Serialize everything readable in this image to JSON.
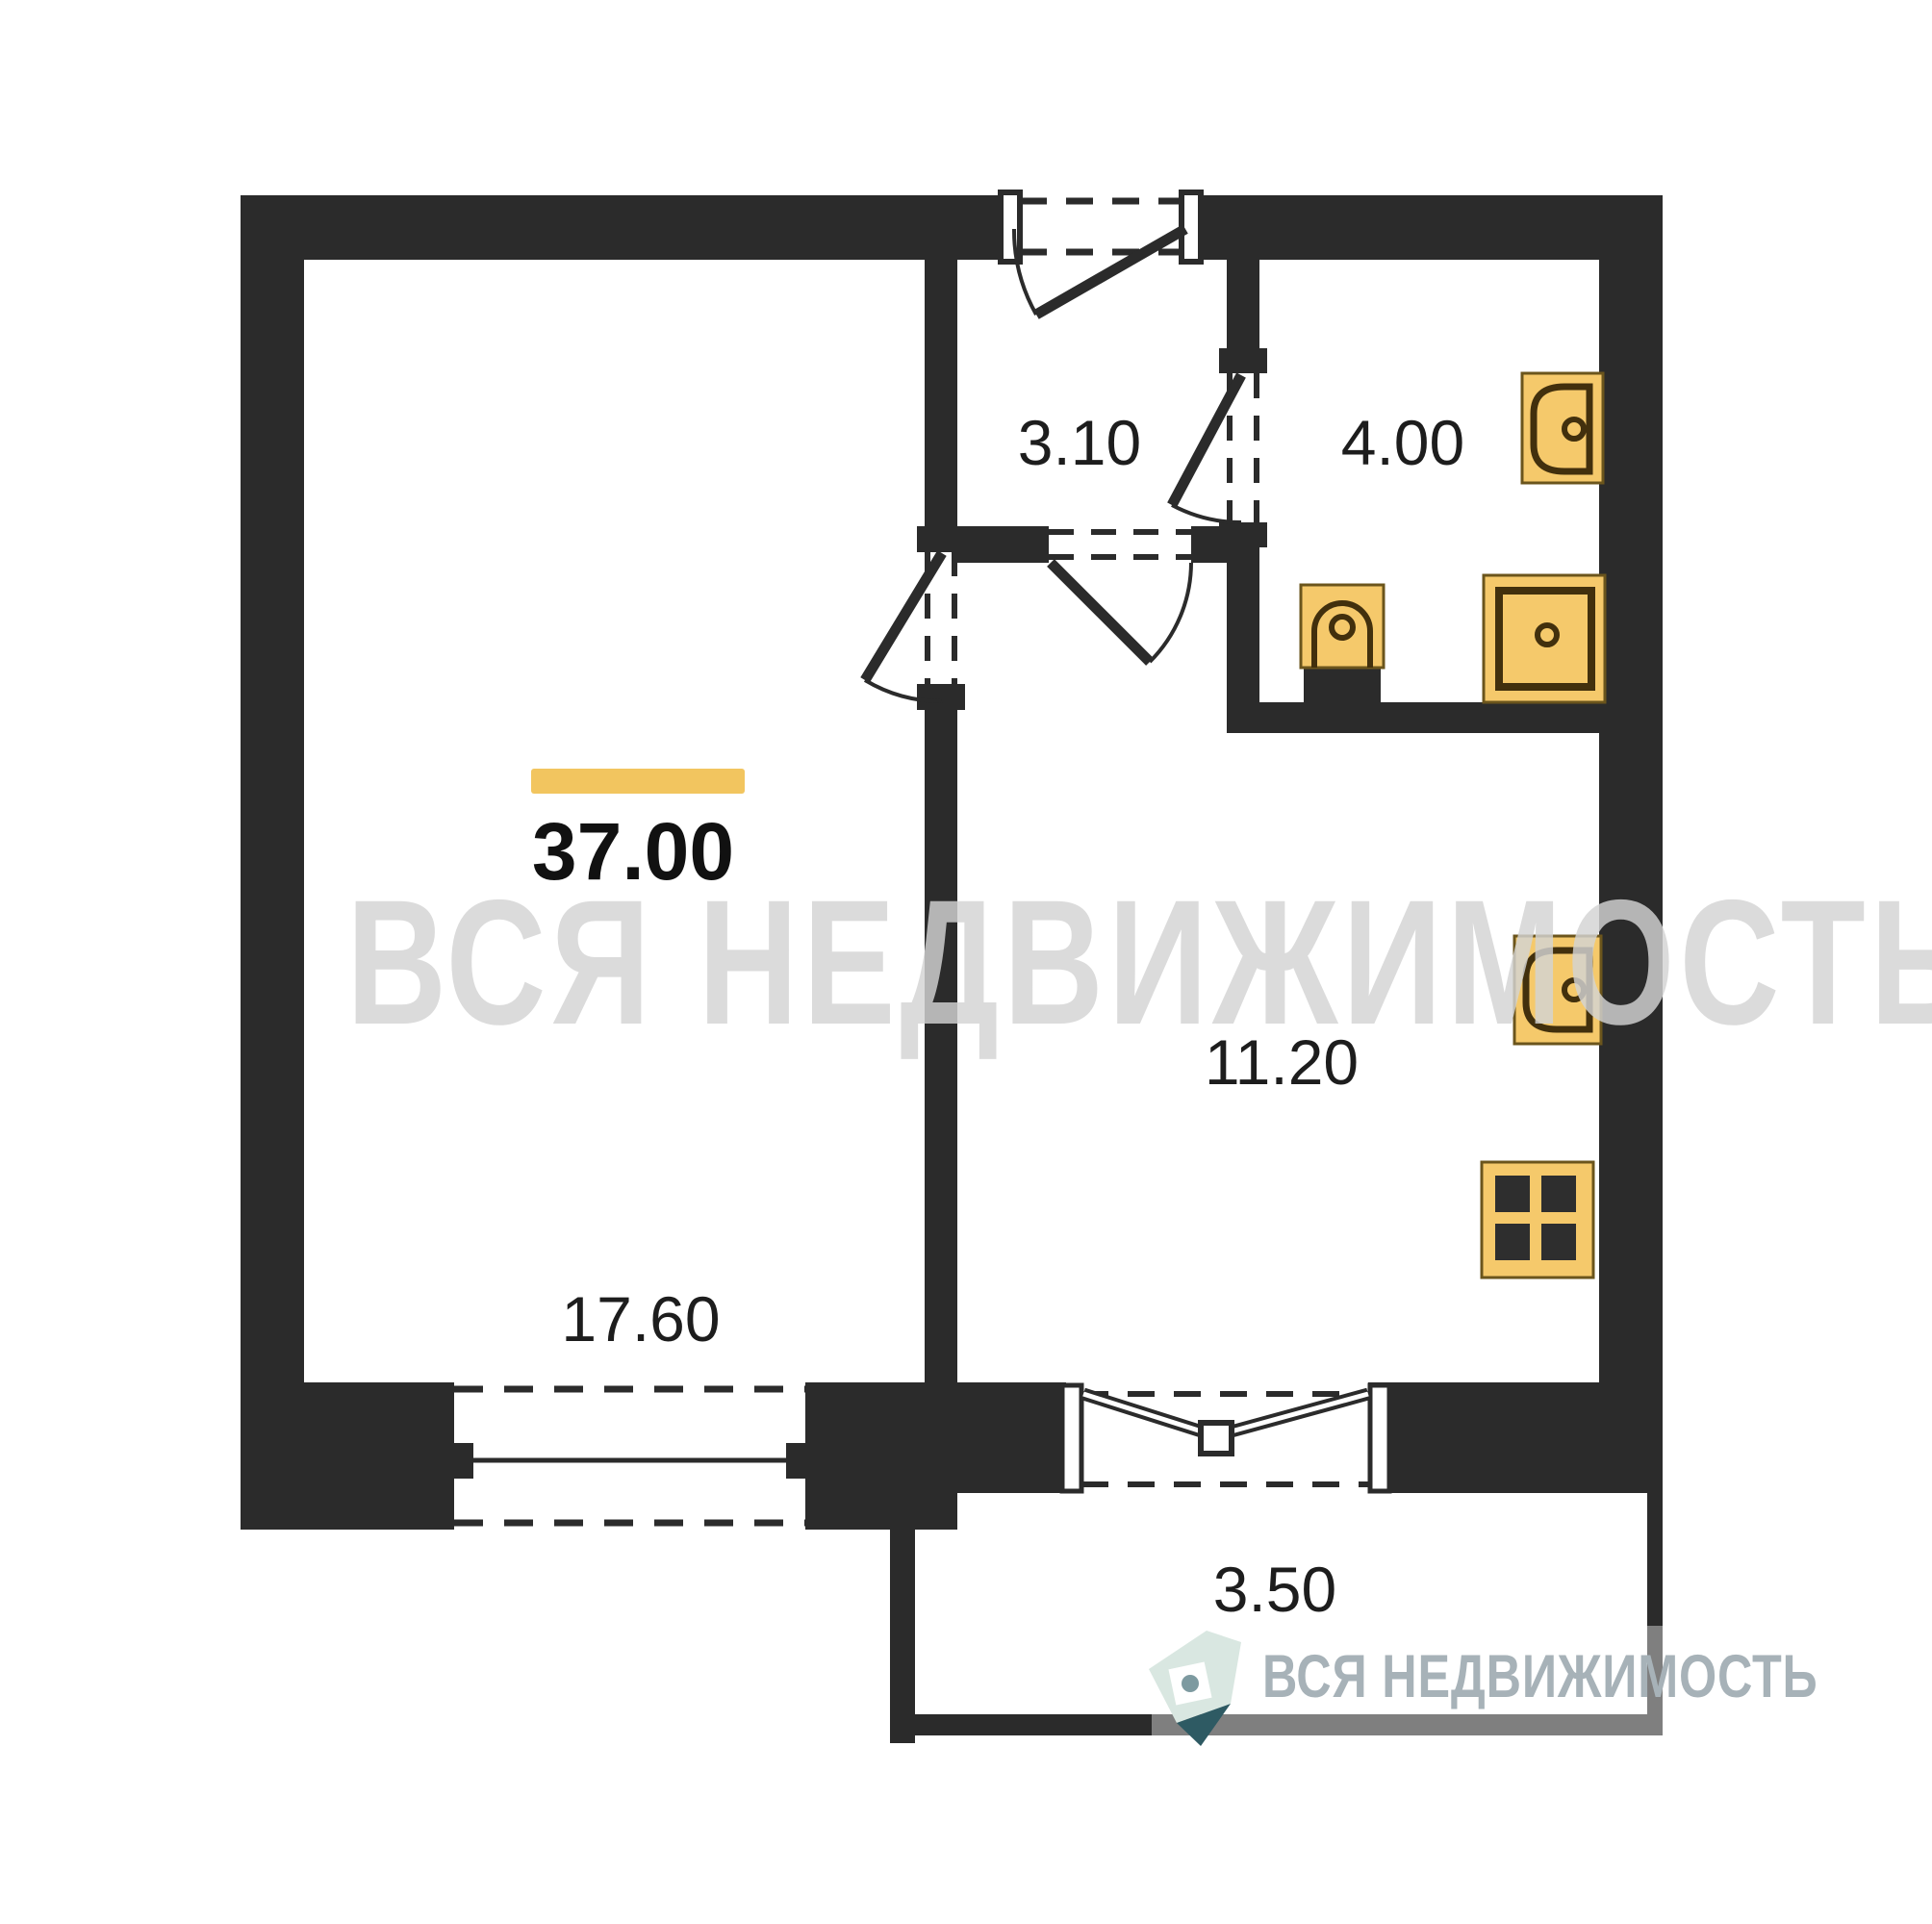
{
  "total": {
    "area": "37.00"
  },
  "rooms": {
    "hallway": {
      "area": "3.10"
    },
    "bathroom": {
      "area": "4.00"
    },
    "kitchen": {
      "area": "11.20"
    },
    "living": {
      "area": "17.60"
    },
    "balcony": {
      "area": "3.50"
    }
  },
  "watermark": {
    "text": "ВСЯ НЕДВИЖИМОСТЬ"
  },
  "logo": {
    "brand": "ВСЯ НЕДВИЖИМОСТЬ"
  },
  "colors": {
    "wall": "#2b2b2b",
    "accent_bar": "#F2C55F",
    "fixture_fill": "#F5C96B",
    "fixture_stroke": "#6B551C",
    "fixture_detail": "#42300D",
    "burner": "#2e2e2e",
    "balcony_outline": "#7F7F7F",
    "watermark_gray": "#D4D4D4",
    "logo_text": "#A7B2B8",
    "logo_mint": "#D9E7E1",
    "logo_teal": "#2E5A63"
  },
  "icons": {
    "bathroom": [
      "washbasin-icon",
      "toilet-icon",
      "shower-tray-icon"
    ],
    "kitchen": [
      "kitchen-sink-icon",
      "stove-icon"
    ]
  }
}
